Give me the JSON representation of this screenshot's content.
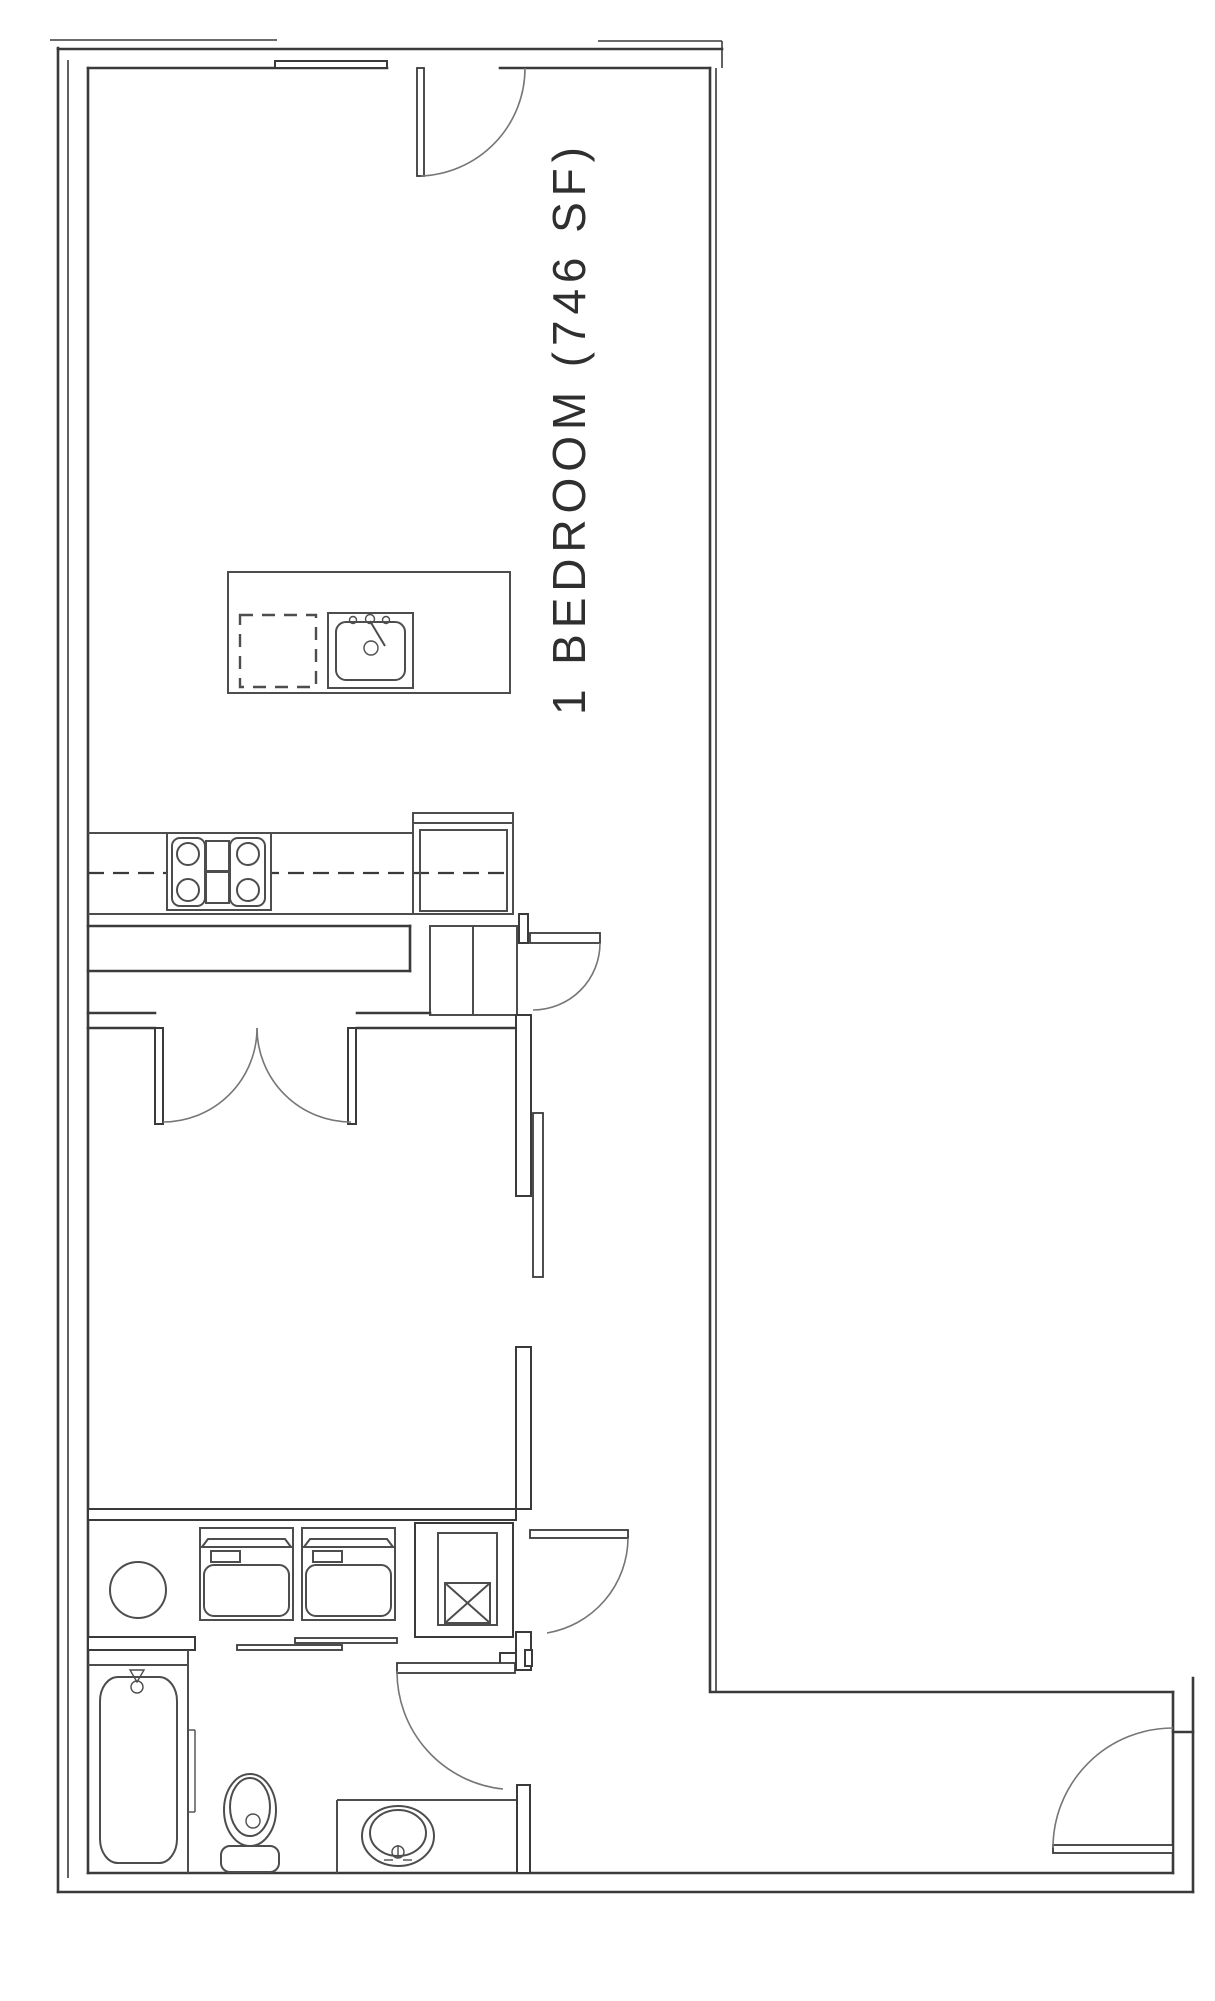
{
  "plan": {
    "label": "1 BEDROOM (746 SF)",
    "unit_type": "1 BEDROOM",
    "area": "746 SF"
  },
  "colors": {
    "background": "#ffffff",
    "wall-line": "#3a3a3a",
    "fixture-line": "#4d4d4d",
    "door-arc": "#767676",
    "label-text": "#2f2f2f"
  },
  "fixtures": [
    "entry-door-top",
    "kitchen-island",
    "island-sink",
    "dishwasher-dashed",
    "kitchen-counter",
    "range-cooktop",
    "refrigerator",
    "pantry-closet",
    "hall-closet-door",
    "bedroom-double-doors",
    "bedroom-sliding-door",
    "laundry-sink-circle",
    "washer",
    "dryer",
    "utility-shaft",
    "laundry-bypass-doors",
    "bathtub",
    "toilet",
    "vanity-sink",
    "bathroom-door",
    "hall-laundry-door",
    "unit-entry-door"
  ]
}
